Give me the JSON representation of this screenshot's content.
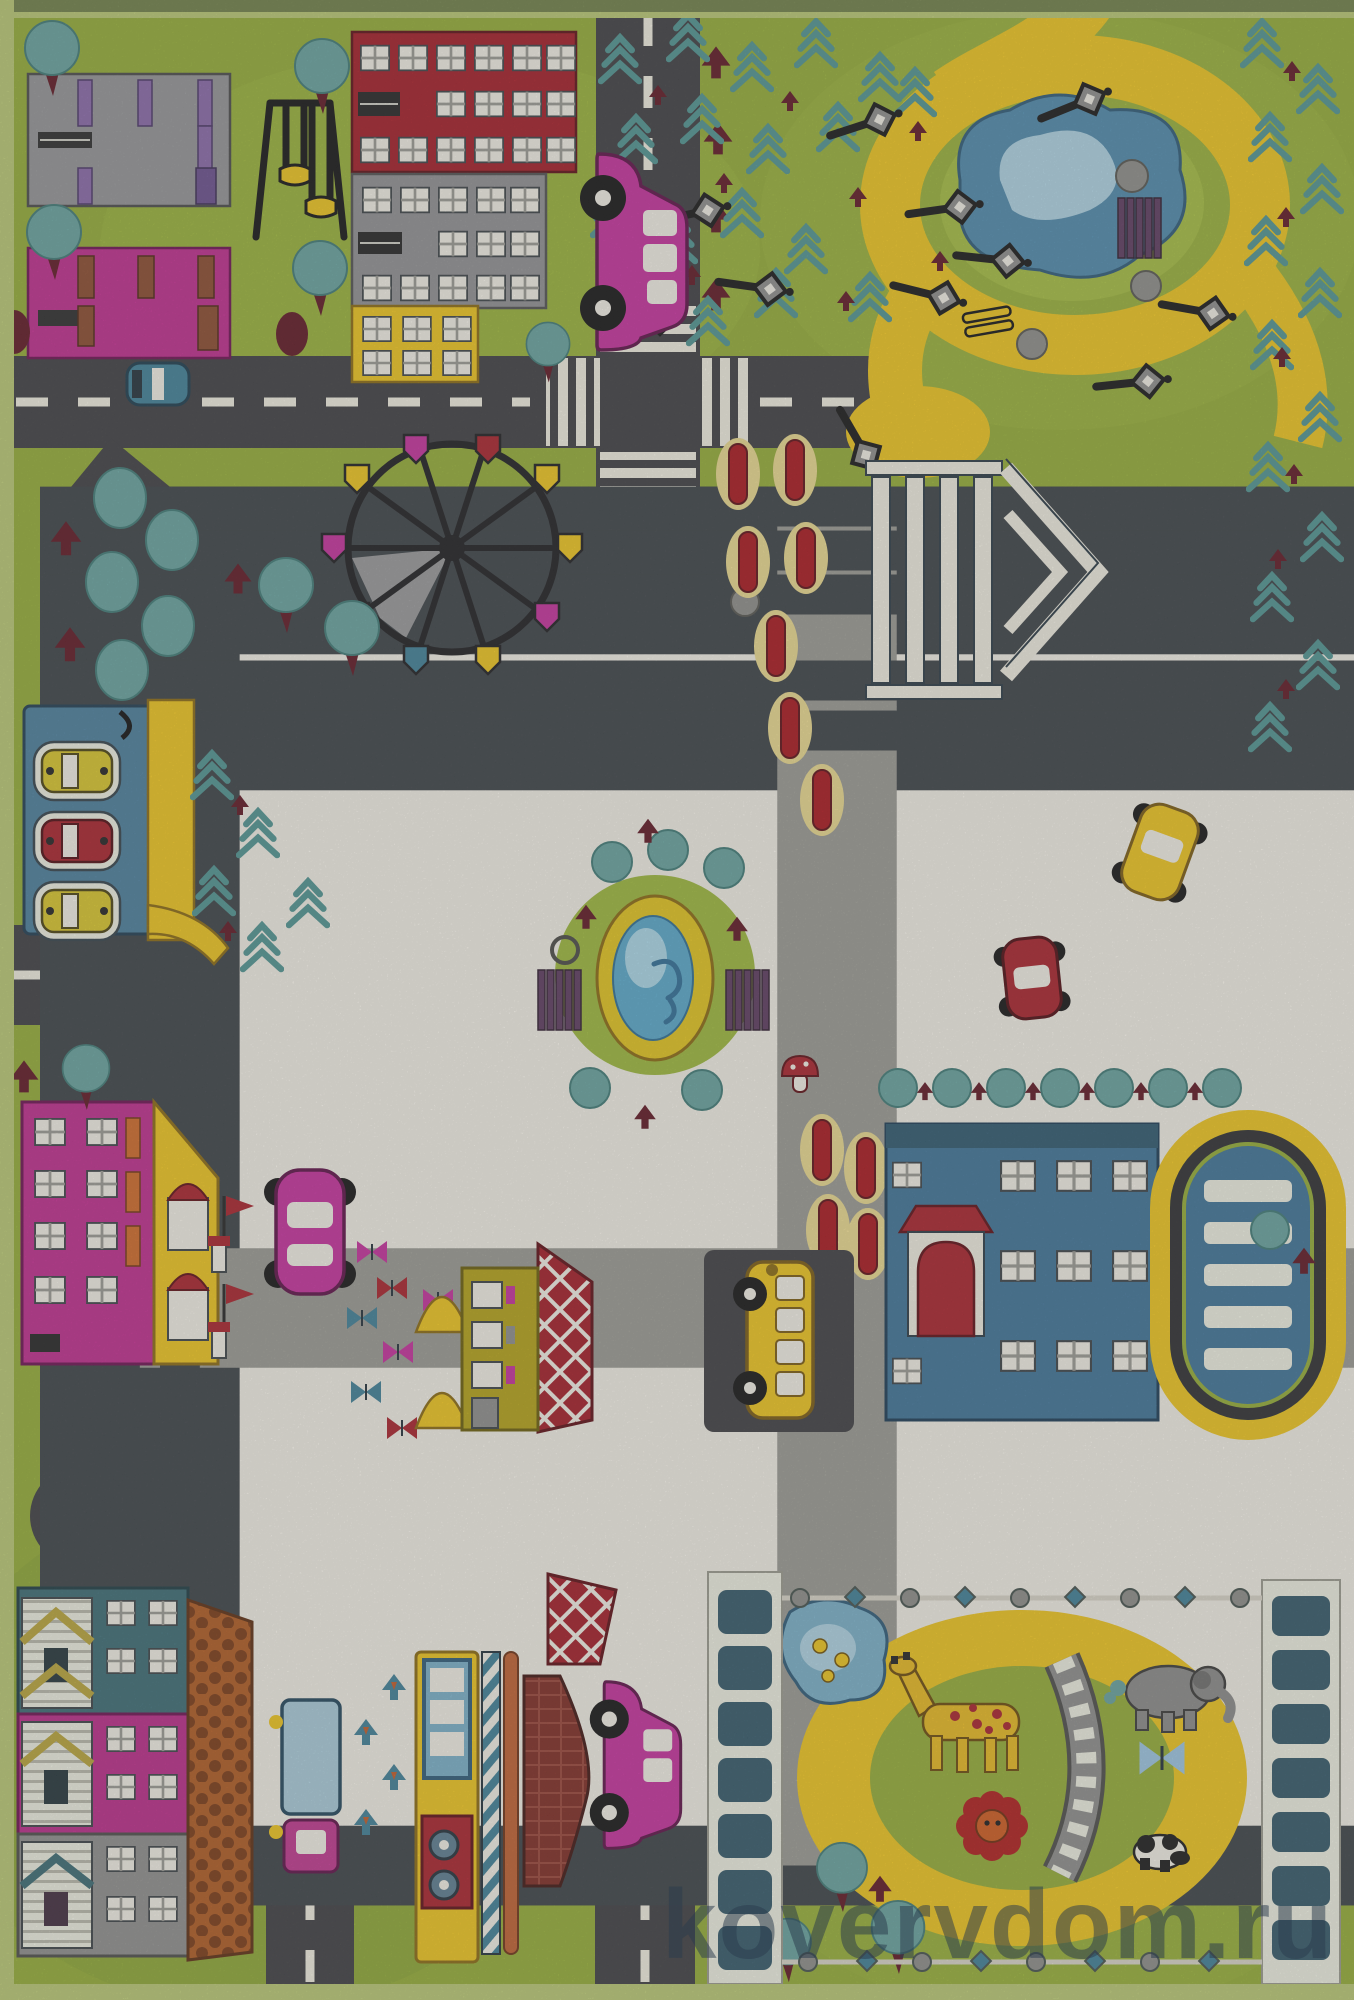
{
  "image_type": "product photo of a children's city-road play rug (top view)",
  "watermark": {
    "text": "kovervdom.ru"
  },
  "palette": {
    "grass_base": "#93ac35",
    "grass_light": "#a5bd40",
    "grass_dark": "#7d9833",
    "road": "#3e3e41",
    "marking": "#f1eee1",
    "off_white": "#f2efe6",
    "red": "#a8202a",
    "dark_red_building": "#a31c26",
    "maroon": "#5f1722",
    "magenta": "#bf2b8d",
    "pink_car": "#c4309c",
    "yellow": "#eec41d",
    "olive": "#b3a118",
    "gray_building": "#939496",
    "school_blue": "#3e7296",
    "pond_blue": "#4e89ab",
    "pond_light": "#aed3e3",
    "teal": "#66a29e",
    "pine": "#4f9391",
    "purple_bench": "#5d3a5f",
    "orange": "#c06030",
    "brown_shingle": "#b05a20",
    "truck_blue": "#a9cbd9",
    "outline": "#22303a",
    "rug_edge": "#b9c873",
    "watermark_color": "rgba(43,60,76,0.52)"
  },
  "scene": {
    "top_left_city": [
      "gray apartment block with white and purple windows",
      "magenta apartment block",
      "red brick office block",
      "gray office block",
      "yellow house",
      "swing playground frame",
      "round teal trees"
    ],
    "top_right_park": [
      "teal fir trees",
      "yellow walking path loop",
      "blue pond with light center",
      "street lamps with diamond lanterns",
      "purple bench",
      "yellow bench",
      "gray bushes",
      "maroon shrubs"
    ],
    "center": [
      "roundabout with fountain and swan",
      "purple park benches",
      "white column gazebo with pediment",
      "ferris wheel with colored gondolas",
      "red flower beds",
      "red mushroom"
    ],
    "left": [
      "car garage with three parking bays (yellow, red, yellow cars)",
      "diagonal avenue",
      "kindergarten with magenta walls and yellow gable, chimneys with red flags"
    ],
    "mid_bottom": [
      "butterfly yard (red, blue, magenta butterflies, yellow tents)",
      "olive house with red lattice roof",
      "blue school with red arched entrance",
      "oval parking lot with white bays",
      "row of trimmed teal trees"
    ],
    "bottom_left": [
      "three row houses (teal, magenta, gray) with striped porches",
      "long brown shingled roof",
      "blue box truck",
      "pink cars"
    ],
    "bottom_middle": [
      "yellow kiosk-tram with wheels",
      "striped barber pole",
      "orange pole",
      "dark red brick house",
      "swallow birds"
    ],
    "zoo": [
      "ornamental chain fence borders",
      "panel fences left and right",
      "yellow path ring",
      "pond with ducks",
      "giraffe",
      "elephant",
      "railway bridge arc",
      "blue butterfly",
      "red flower-lion",
      "panda"
    ],
    "vehicles_on_roads": [
      "pink side-view car (top road)",
      "small teal car",
      "pink top-view car",
      "red top-view car",
      "yellow top-view car",
      "yellow bus in lay-by",
      "pink side-view car (bottom road)"
    ]
  }
}
